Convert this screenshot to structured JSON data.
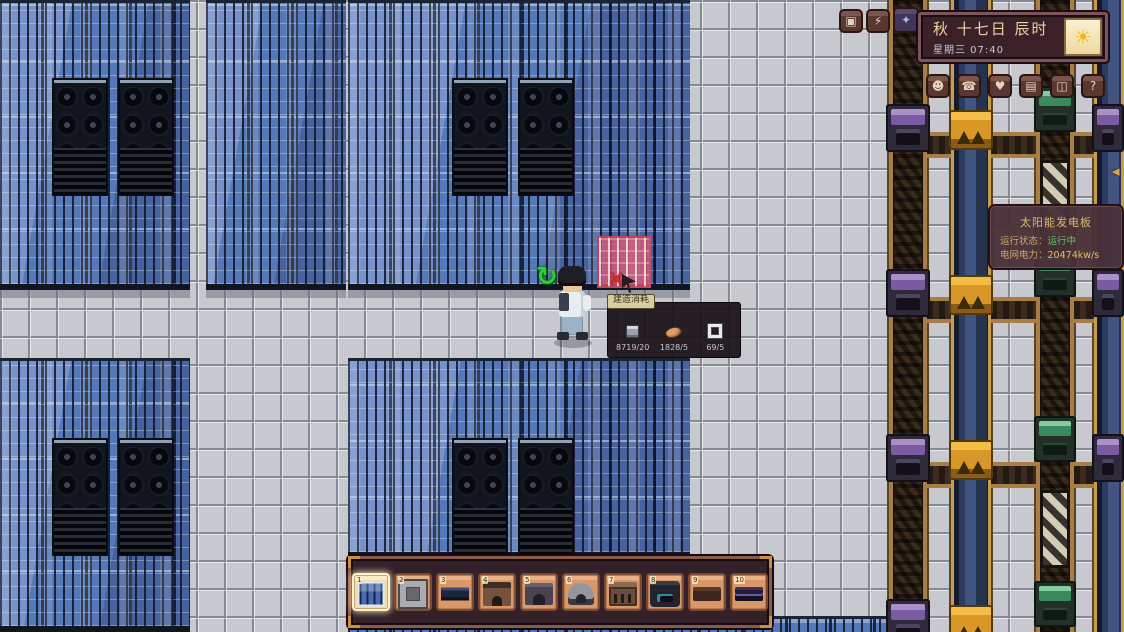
{
  "hud": {
    "top_buttons": [
      {
        "name": "ornament-button",
        "glyph": "▣"
      },
      {
        "name": "energy-button",
        "glyph": "⚡"
      },
      {
        "name": "gem-button",
        "glyph": "✦"
      }
    ],
    "date_panel": {
      "date": "秋 十七日 辰时",
      "weekday_time": "星期三 07:40",
      "weather": "sunny",
      "weather_glyph": "☀"
    },
    "menu_buttons": [
      {
        "name": "character-menu",
        "glyph": "☻"
      },
      {
        "name": "phone-menu",
        "glyph": "☎"
      },
      {
        "name": "social-menu",
        "glyph": "♥"
      },
      {
        "name": "catalog-menu",
        "glyph": "▤"
      },
      {
        "name": "inventory-menu",
        "glyph": "◫"
      },
      {
        "name": "help-menu",
        "glyph": "?"
      }
    ],
    "edge_tab_glyph": "◂"
  },
  "build_tooltip": {
    "label": "建造消耗",
    "items": [
      {
        "icon": "stone-block-icon",
        "count": "8719/20"
      },
      {
        "icon": "copper-ingot-icon",
        "count": "1828/5"
      },
      {
        "icon": "glass-frame-icon",
        "count": "69/5"
      }
    ]
  },
  "info_tooltip": {
    "title": "太阳能发电板",
    "status_label": "运行状态：",
    "status_value": "运行中",
    "power_label": "电网电力：",
    "power_value": "20474kw/s"
  },
  "hotbar": {
    "slots": [
      {
        "num": "1",
        "item": "solar-panel",
        "selected": true
      },
      {
        "num": "2",
        "item": "stone-frame",
        "selected": false
      },
      {
        "num": "3",
        "item": "panel-slab",
        "selected": false
      },
      {
        "num": "4",
        "item": "furnace",
        "selected": false
      },
      {
        "num": "5",
        "item": "press-machine",
        "selected": false
      },
      {
        "num": "6",
        "item": "dome-machine",
        "selected": false
      },
      {
        "num": "7",
        "item": "gate-machine",
        "selected": false
      },
      {
        "num": "8",
        "item": "generator",
        "selected": false
      },
      {
        "num": "9",
        "item": "wood-slab",
        "selected": false
      },
      {
        "num": "10",
        "item": "conveyor-slab",
        "selected": false
      }
    ]
  },
  "world": {
    "rotate_glyph": "↻",
    "invalid_glyph": "×"
  },
  "colors": {
    "accent_gold": "#d8a84a",
    "status_green": "#58c868",
    "panel_blue": "#5478b8",
    "hud_maroon": "#3b2127"
  }
}
